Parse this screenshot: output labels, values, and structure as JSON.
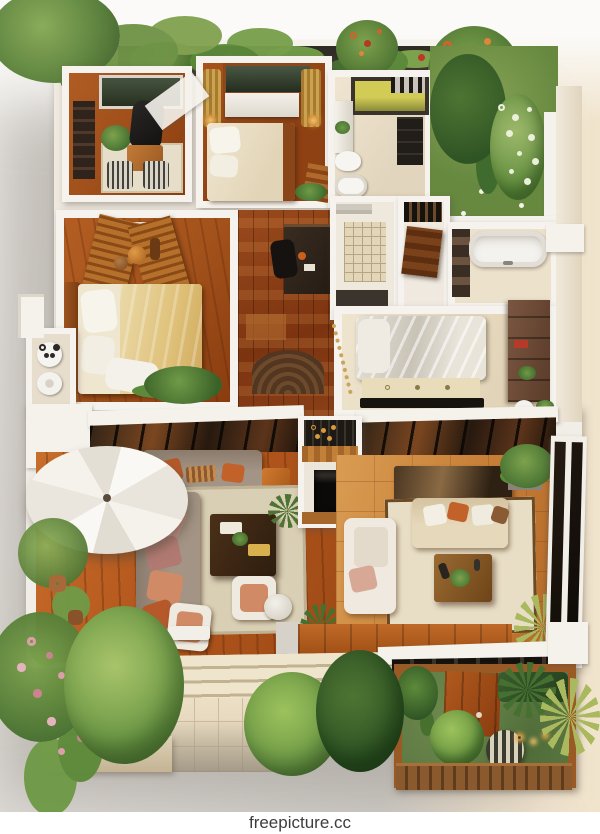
{
  "scene": {
    "alt": "Isometric 3D render of a furnished two-level apartment floor plan: upper floor with office, two bedrooms, kitchen, shower room, bathtub bathroom and a private tree garden; lower level with wooden deck terrace, white parasol, sectional sofas, fireplace column, living room, and landscaped gardens with a fenced courtyard below"
  },
  "watermark": {
    "text": "freepicture.cc"
  },
  "palette": {
    "wall_white": "#f5f2ec",
    "deck_wood": "#b4571d",
    "living_parquet": "#c9823a",
    "hall_wood": "#7c3410",
    "bedroom_wood": "#a3521b",
    "lawn_green": "#5d7842",
    "foliage_dark": "#3f6b2e",
    "foliage_light": "#8fb05a",
    "flower_pink": "#d9a0a8",
    "flower_orange": "#c86a2a",
    "flower_red": "#b33a22",
    "umbrella_white": "#f7f5f0",
    "sofa_taupe": "#9a8b7c",
    "sofa_cream": "#e2d2b2",
    "pillow_salmon": "#d08a66",
    "pillow_rust": "#b5592a",
    "rug_beige": "#d9cfb4",
    "glass_dark": "#27190f",
    "bath_white": "#f4f2ee",
    "curtain_gold": "#caa34e",
    "background_gray": "#d2cfcb",
    "background_warm": "#f2e5cf",
    "watermark_bg": "#ffffff",
    "watermark_text": "#3d3d3d"
  }
}
